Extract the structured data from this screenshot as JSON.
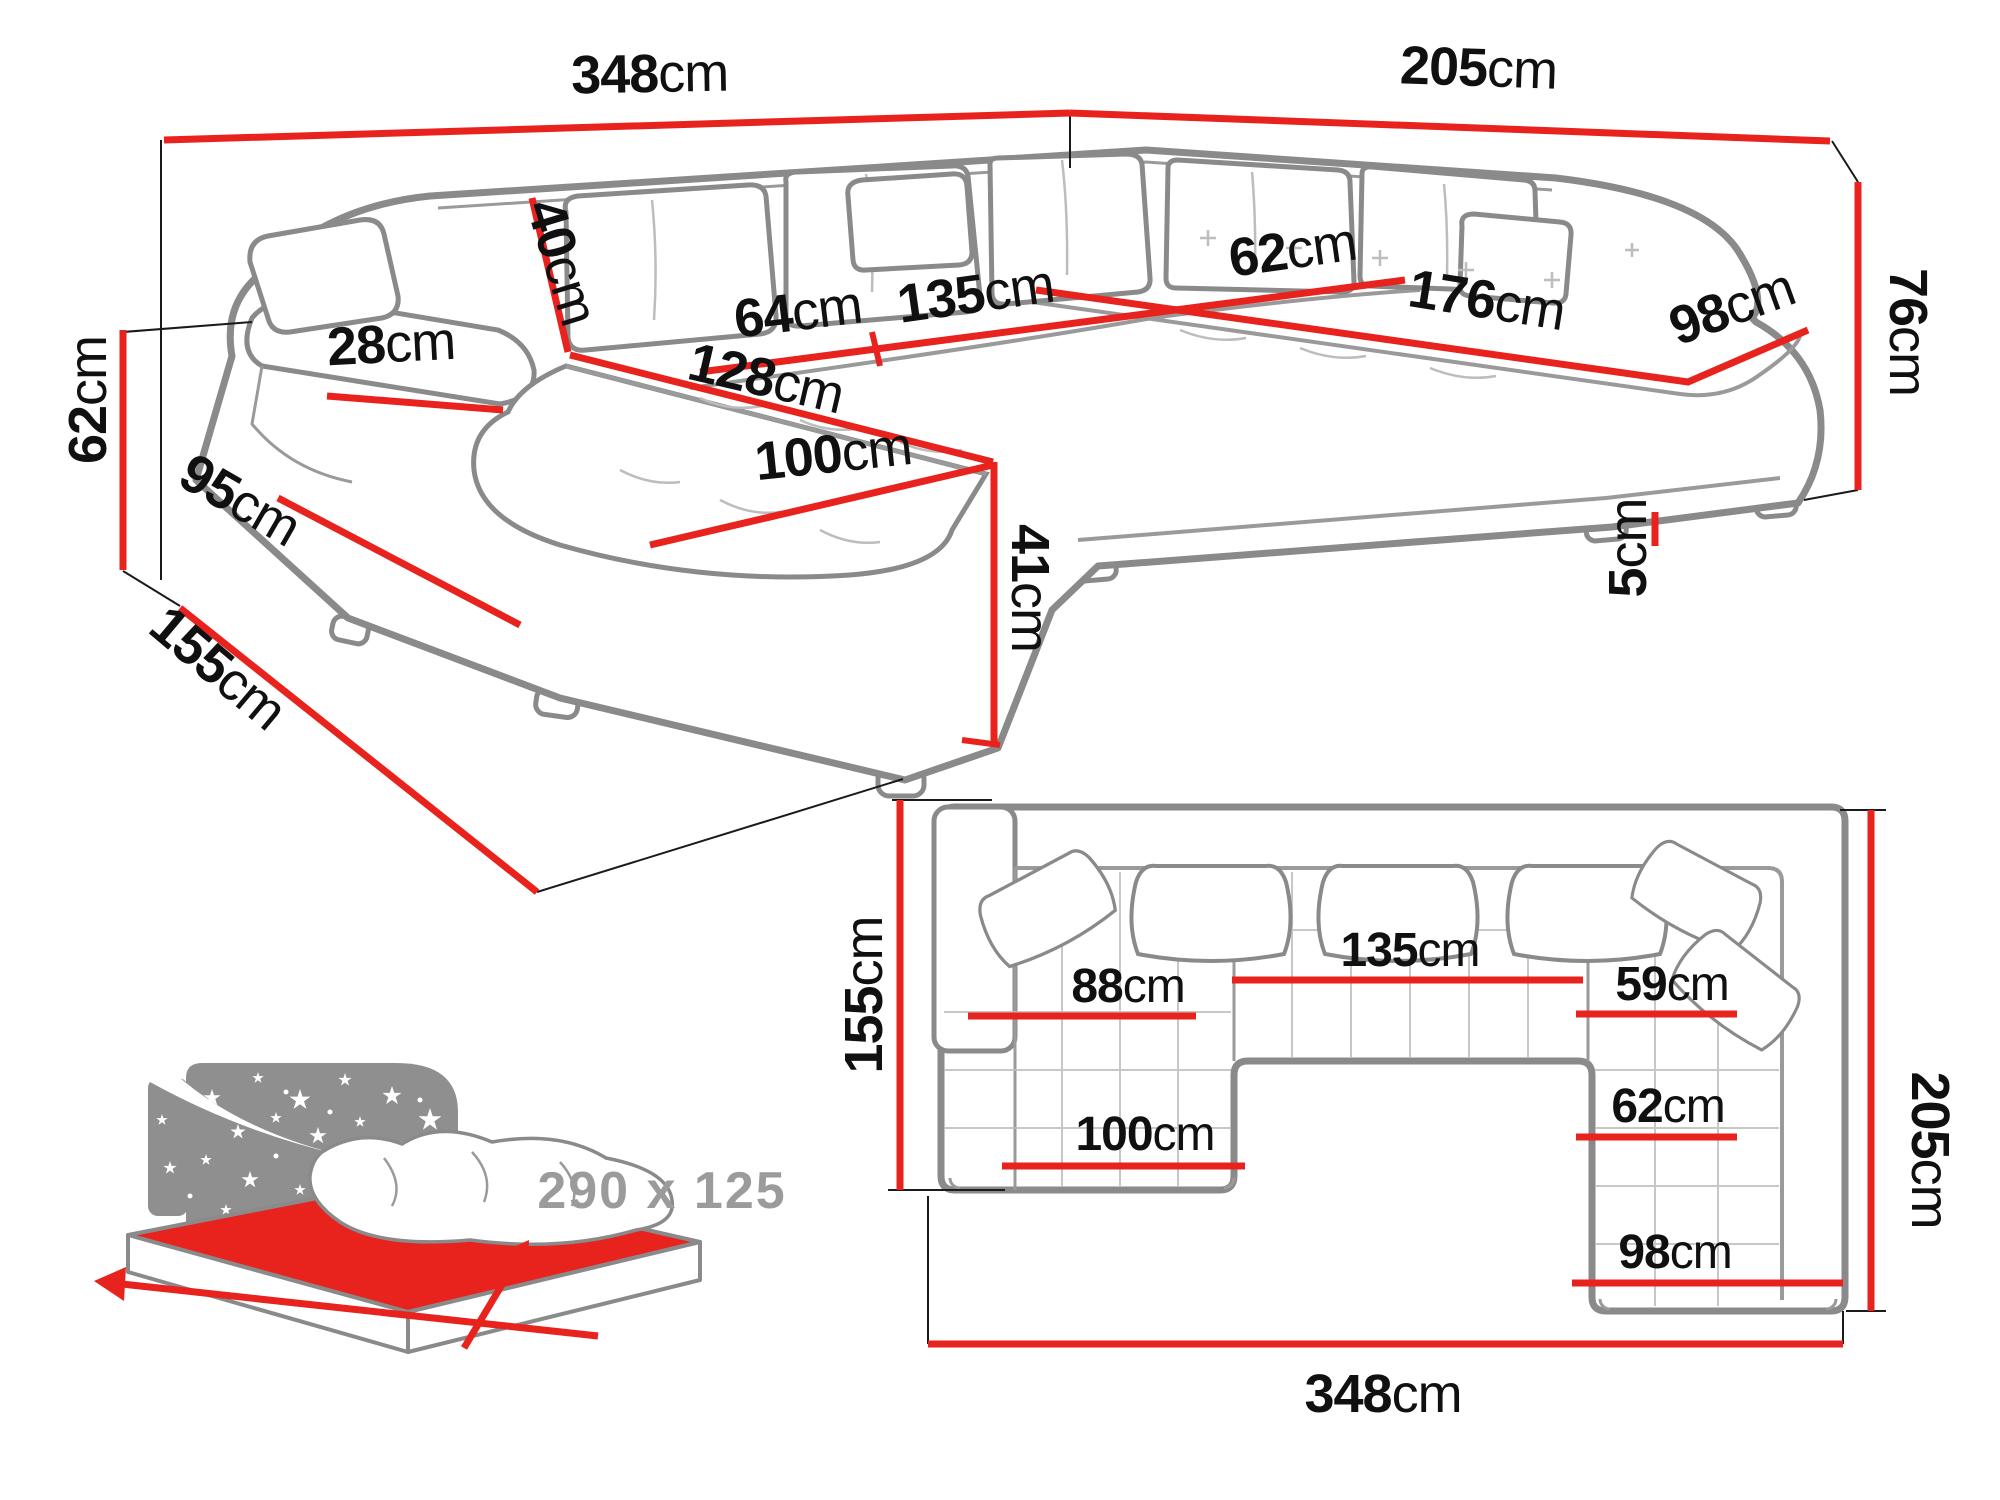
{
  "colors": {
    "dimension_red": "#e8231e",
    "label_ink": "#101010",
    "sofa_outline_grey": "#8a8a8a",
    "icon_grey": "#8f8f8f",
    "icon_text_grey": "#9b9b9b"
  },
  "perspective_view": {
    "dims": {
      "back_width": {
        "value": "348",
        "unit": "cm"
      },
      "right_width": {
        "value": "205",
        "unit": "cm"
      },
      "left_height": {
        "value": "62",
        "unit": "cm"
      },
      "left_depth": {
        "value": "155",
        "unit": "cm"
      },
      "left_base": {
        "value": "95",
        "unit": "cm"
      },
      "armrest_width": {
        "value": "28",
        "unit": "cm"
      },
      "cushion": {
        "value": "40",
        "unit": "cm"
      },
      "seat_64": {
        "value": "64",
        "unit": "cm"
      },
      "seat_135": {
        "value": "135",
        "unit": "cm"
      },
      "seat_62": {
        "value": "62",
        "unit": "cm"
      },
      "seat_176": {
        "value": "176",
        "unit": "cm"
      },
      "seat_98": {
        "value": "98",
        "unit": "cm"
      },
      "seat_depth_128": {
        "value": "128",
        "unit": "cm"
      },
      "chaise_100": {
        "value": "100",
        "unit": "cm"
      },
      "chaise_height_41": {
        "value": "41",
        "unit": "cm"
      },
      "leg_height_5": {
        "value": "5",
        "unit": "cm"
      },
      "back_height_76": {
        "value": "76",
        "unit": "cm"
      }
    }
  },
  "plan_view": {
    "dims": {
      "total_width": {
        "value": "348",
        "unit": "cm"
      },
      "total_depth": {
        "value": "205",
        "unit": "cm"
      },
      "chaise_depth": {
        "value": "155",
        "unit": "cm"
      },
      "chaise_seat_88": {
        "value": "88",
        "unit": "cm"
      },
      "middle_seat_135": {
        "value": "135",
        "unit": "cm"
      },
      "right_seat_59": {
        "value": "59",
        "unit": "cm"
      },
      "right_seat_62": {
        "value": "62",
        "unit": "cm"
      },
      "chaise_width_100": {
        "value": "100",
        "unit": "cm"
      },
      "right_width_98": {
        "value": "98",
        "unit": "cm"
      }
    }
  },
  "sleeping_icon": {
    "bed_size_label": "290 x 125"
  }
}
